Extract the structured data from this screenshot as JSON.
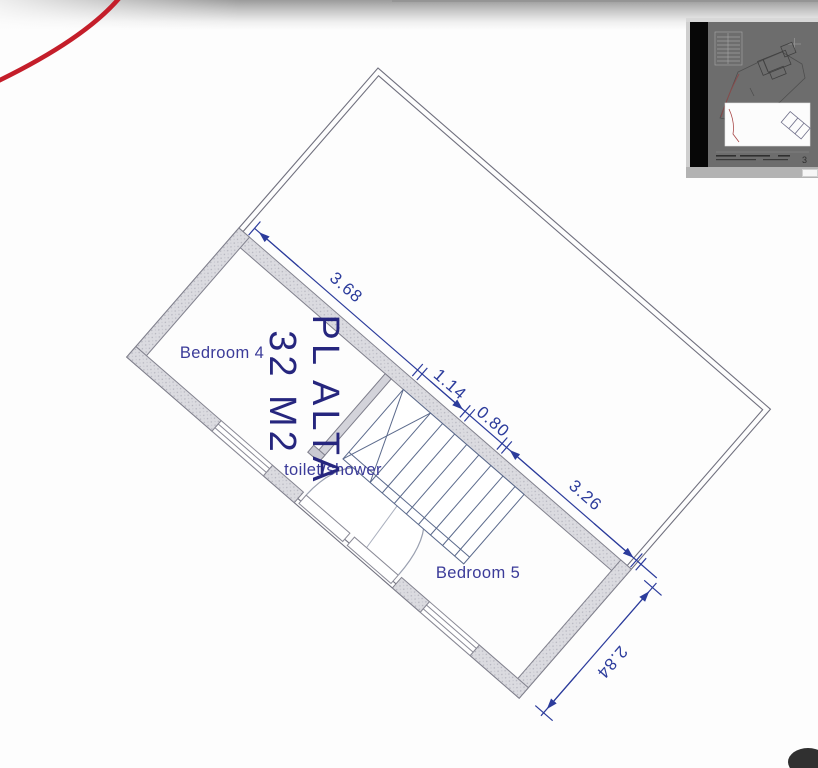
{
  "plan": {
    "floor_title": "PL ALTA",
    "floor_area": "32 M2",
    "rooms": {
      "bedroom4": "Bedroom 4",
      "toilet": "toilet/shower",
      "bedroom5": "Bedroom 5"
    },
    "dimensions": {
      "top_wall_segment1": "3.68",
      "top_wall_segment2": "1.14",
      "top_wall_segment3": "0.80",
      "top_wall_segment4": "3.26",
      "side_wall": "2.84"
    },
    "colors": {
      "ink_blue": "#2c3c9c",
      "label_blue": "#3b3b99",
      "title_navy": "#26267e",
      "wall_fill": "#dbdbe0",
      "wall_line": "#82828e",
      "boundary_line": "#70707e",
      "red_pen": "#c41e2a"
    }
  },
  "navigator": {
    "sheet_number": "3",
    "colors": {
      "page_gray": "#6d6d6d",
      "bar_black": "#070707",
      "viewport_white": "#fcfcfc"
    }
  }
}
